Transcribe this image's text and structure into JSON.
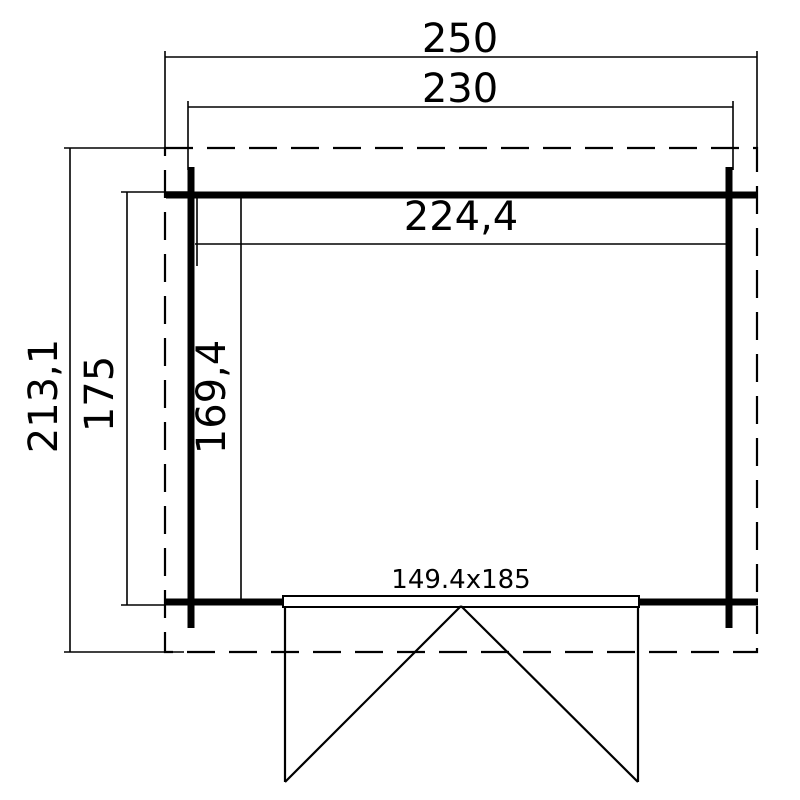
{
  "dimensions": {
    "overall_width": "250",
    "wall_outer_width": "230",
    "interior_width": "224,4",
    "overall_depth": "213,1",
    "wall_outer_depth": "175",
    "interior_depth": "169,4",
    "door_size": "149.4x185"
  },
  "colors": {
    "line": "#000000",
    "background": "#ffffff"
  }
}
